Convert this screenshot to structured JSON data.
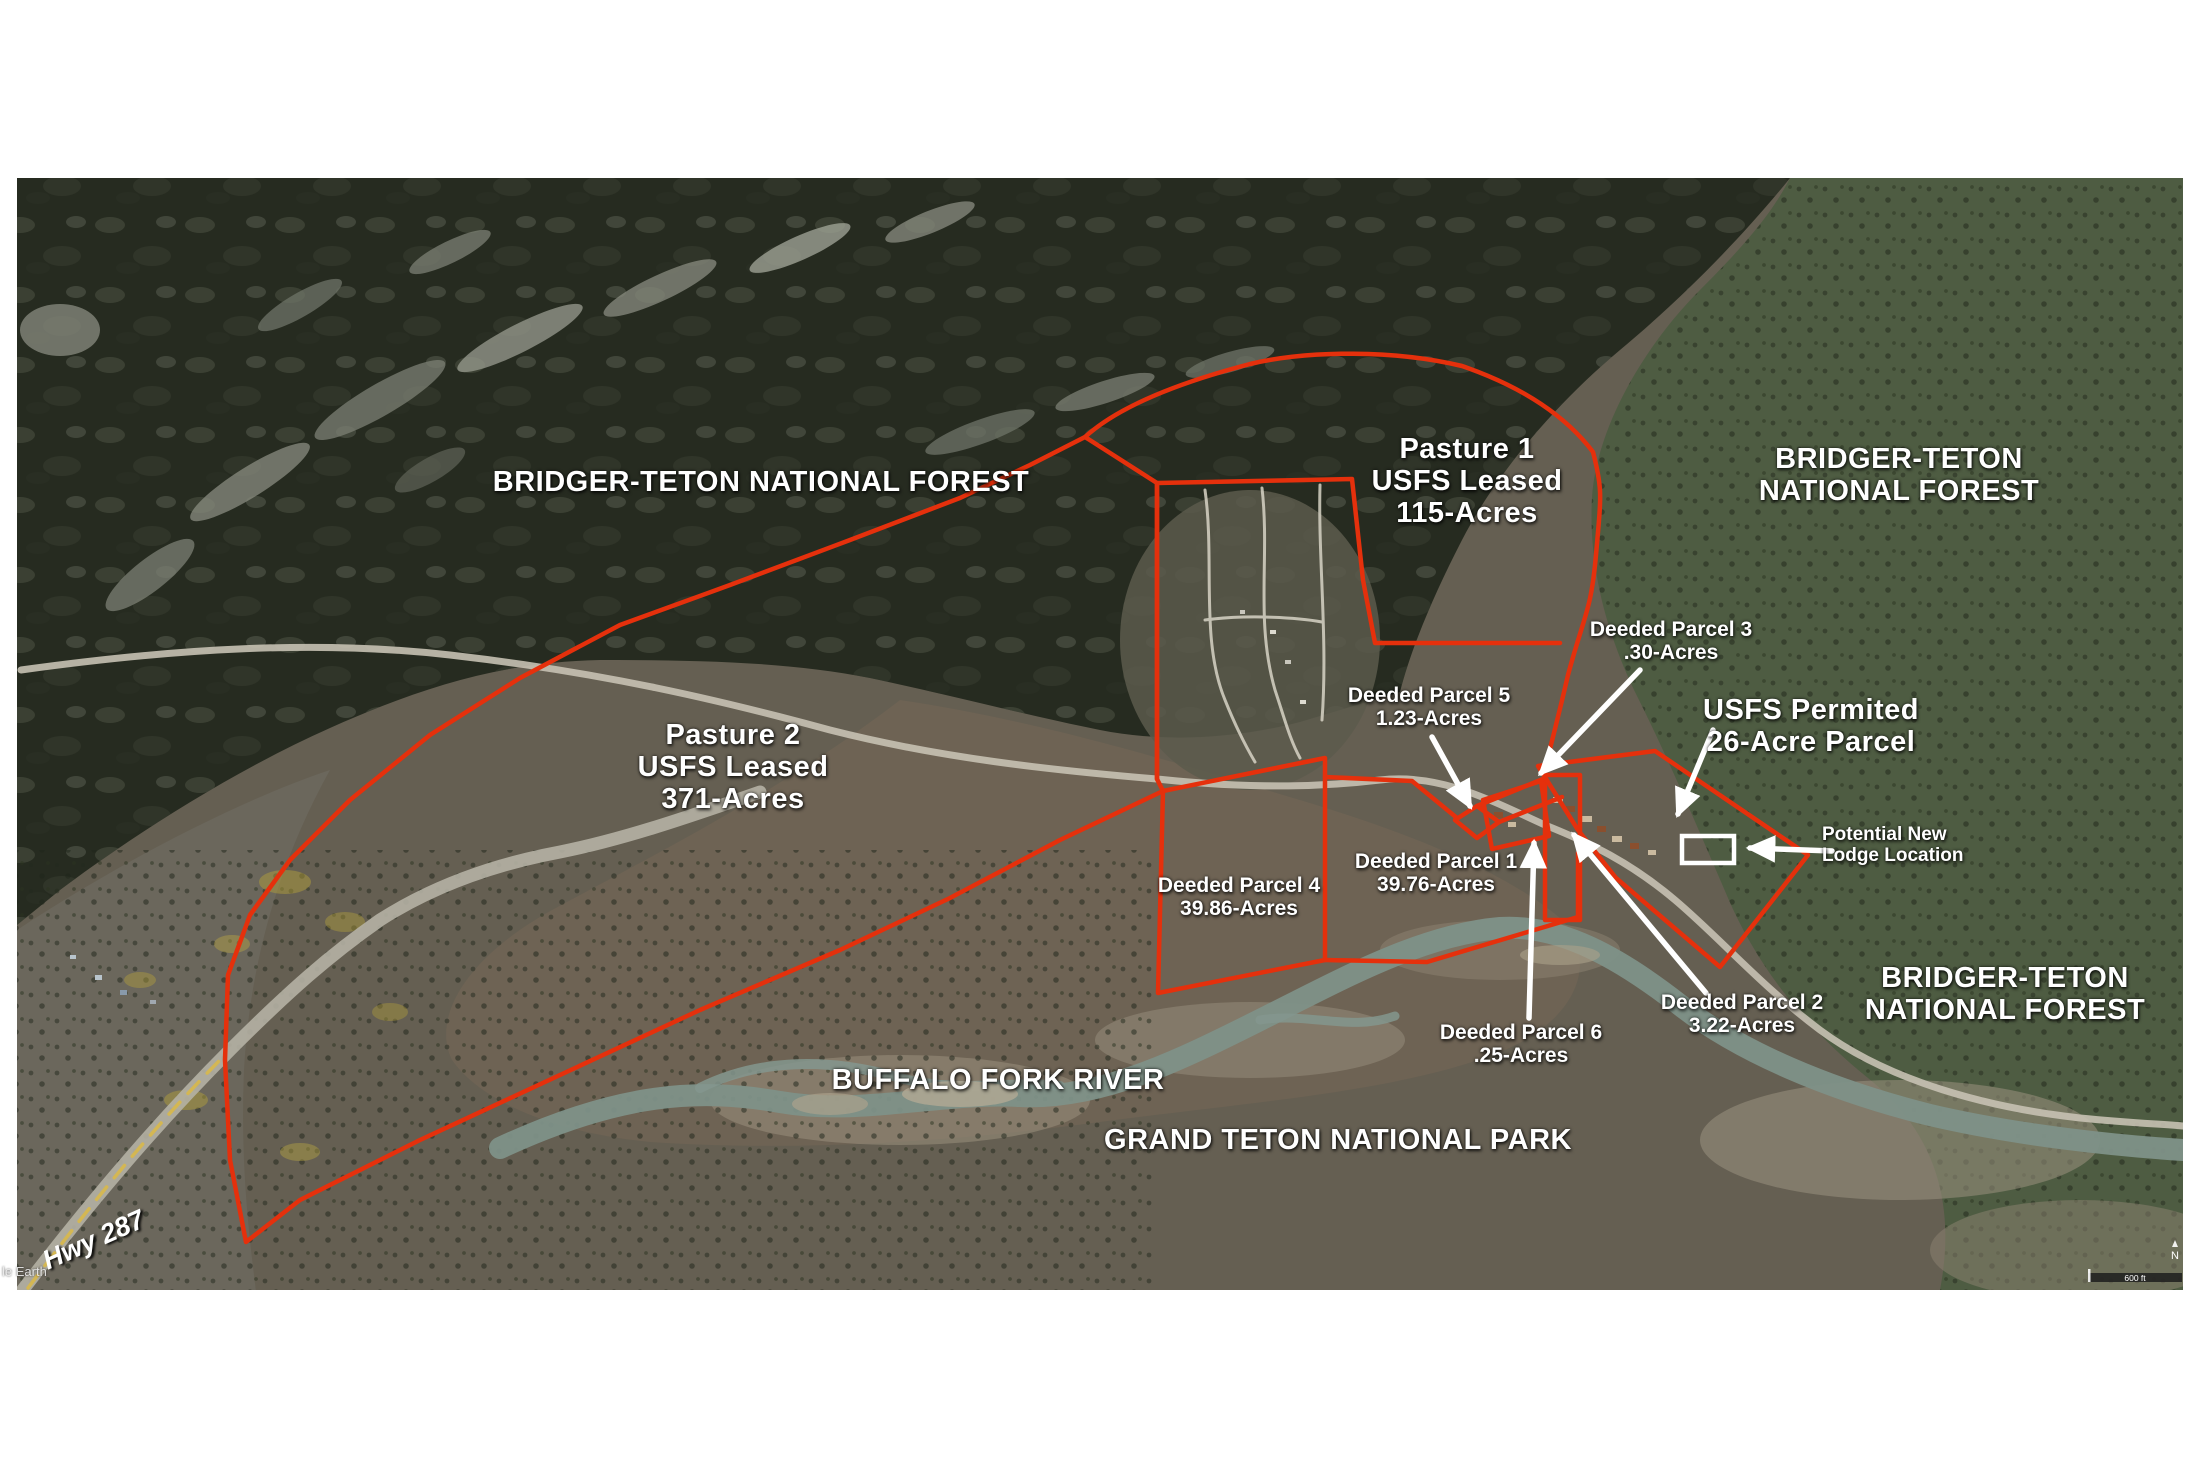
{
  "colors": {
    "boundary_red": "#e5300c",
    "annotation_white": "#ffffff",
    "forest_dark": "#262b20",
    "forest_green": "#4e5c42",
    "valley_tan": "#6e6354",
    "river_gray": "#7e9188"
  },
  "regions": {
    "forest_nw": "BRIDGER-TETON NATIONAL FOREST",
    "forest_ne_line1": "BRIDGER-TETON",
    "forest_ne_line2": "NATIONAL FOREST",
    "forest_e_line1": "BRIDGER-TETON",
    "forest_e_line2": "NATIONAL FOREST",
    "park": "GRAND TETON NATIONAL PARK",
    "river": "BUFFALO FORK RIVER",
    "highway": "Hwy 287"
  },
  "pastures": {
    "pasture1_name": "Pasture 1",
    "pasture1_tenure": "USFS Leased",
    "pasture1_acreage": "115-Acres",
    "pasture2_name": "Pasture 2",
    "pasture2_tenure": "USFS Leased",
    "pasture2_acreage": "371-Acres"
  },
  "permit": {
    "line1": "USFS Permited",
    "line2": "26-Acre Parcel"
  },
  "lodge": {
    "line1": "Potential New",
    "line2": "Lodge Location"
  },
  "parcels": {
    "p1_name": "Deeded Parcel 1",
    "p1_acreage": "39.76-Acres",
    "p2_name": "Deeded Parcel 2",
    "p2_acreage": "3.22-Acres",
    "p3_name": "Deeded Parcel 3",
    "p3_acreage": ".30-Acres",
    "p4_name": "Deeded Parcel 4",
    "p4_acreage": "39.86-Acres",
    "p5_name": "Deeded Parcel 5",
    "p5_acreage": "1.23-Acres",
    "p6_name": "Deeded Parcel 6",
    "p6_acreage": ".25-Acres"
  },
  "footer": {
    "watermark": "le Earth",
    "scale_label": "600 ft",
    "compass": "N"
  }
}
